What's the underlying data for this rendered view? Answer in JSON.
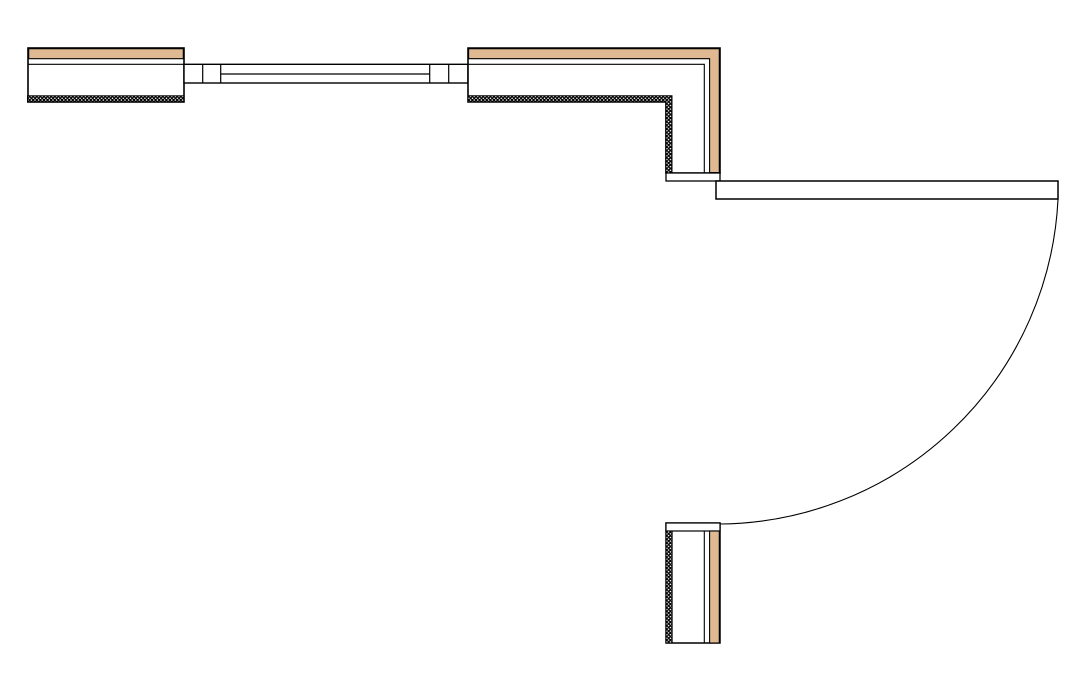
{
  "app": {
    "type": "cad-floor-plan-detail",
    "description": "Plan view of wall assembly with window, corner wall, and 90-degree open door with swing arc"
  },
  "canvas": {
    "width": 1088,
    "height": 681,
    "background": "#FFFFFF"
  },
  "colors": {
    "line": "#000000",
    "wood": "#DEB992",
    "white": "#FFFFFF",
    "stipple_bg": "#000000",
    "stipple_dot": "#FFFFFF"
  },
  "stipple": {
    "tile": 3.6,
    "dot_r": 0.75
  },
  "elements": [
    {
      "name": "left-wall-body",
      "type": "rect",
      "x": 28,
      "y": 48,
      "w": 156,
      "h": 54,
      "fill": "white",
      "sw": 1.6
    },
    {
      "name": "left-wall-finish-band",
      "type": "rect",
      "x": 28.7,
      "y": 48.7,
      "w": 154.6,
      "h": 10,
      "fill": "wood",
      "sw": 1.1
    },
    {
      "name": "left-wall-finish-line",
      "type": "line",
      "x1": 28,
      "y1": 64.3,
      "x2": 184,
      "y2": 64.3,
      "sw": 1.1
    },
    {
      "name": "left-wall-insulation-band",
      "type": "rect",
      "x": 27.5,
      "y": 95.8,
      "w": 156.5,
      "h": 6.2,
      "fill": "stipple",
      "sw": 1.0
    },
    {
      "name": "window-frame",
      "type": "rect",
      "x": 184,
      "y": 64.3,
      "w": 284,
      "h": 18.7,
      "fill": "white",
      "sw": 1.4
    },
    {
      "name": "window-jamb-line",
      "type": "line",
      "x1": 202.7,
      "y1": 64.3,
      "x2": 202.7,
      "y2": 83,
      "sw": 1.2
    },
    {
      "name": "window-jamb-line",
      "type": "line",
      "x1": 220.7,
      "y1": 64.3,
      "x2": 220.7,
      "y2": 83,
      "sw": 1.2
    },
    {
      "name": "window-jamb-line",
      "type": "line",
      "x1": 429.7,
      "y1": 64.3,
      "x2": 429.7,
      "y2": 83,
      "sw": 1.2
    },
    {
      "name": "window-jamb-line",
      "type": "line",
      "x1": 448.7,
      "y1": 64.3,
      "x2": 448.7,
      "y2": 83,
      "sw": 1.2
    },
    {
      "name": "window-glass-line",
      "type": "line",
      "x1": 220.7,
      "y1": 74,
      "x2": 429.7,
      "y2": 74,
      "sw": 1.2
    },
    {
      "name": "corner-wall-body",
      "type": "path",
      "d": "M468,48 H720 V173 H666 V102 H468 Z",
      "fill": "white",
      "sw": 1.6
    },
    {
      "name": "corner-wall-finish-band",
      "type": "path",
      "d": "M468.6,48.7 H719.3 V172.5 H709.6 V58.7 H468.6 Z",
      "fill": "wood",
      "sw": 1.1
    },
    {
      "name": "corner-wall-finish-line",
      "type": "path",
      "d": "M468,64.3 H704.3 V173",
      "fill": "none",
      "sw": 1.1
    },
    {
      "name": "corner-wall-insulation-band",
      "type": "path",
      "d": "M468,95.8 H672 V173 H665.8 V102 H468 Z",
      "fill": "stipple",
      "sw": 1.0
    },
    {
      "name": "door-head-jamb-cap",
      "type": "rect",
      "x": 666,
      "y": 173,
      "w": 54,
      "h": 8,
      "fill": "white",
      "sw": 1.3
    },
    {
      "name": "door-leaf",
      "type": "rect",
      "x": 716,
      "y": 181,
      "w": 342,
      "h": 18,
      "fill": "white",
      "sw": 1.5
    },
    {
      "name": "door-swing-arc",
      "type": "path",
      "d": "M1058,199.5 A341.5,341.5 0 0 1 719.5,524",
      "fill": "none",
      "sw": 1.1
    },
    {
      "name": "lower-wall-body",
      "type": "rect",
      "x": 666,
      "y": 523,
      "w": 54,
      "h": 120,
      "fill": "white",
      "sw": 1.5
    },
    {
      "name": "lower-wall-jamb-cap",
      "type": "rect",
      "x": 666,
      "y": 523,
      "w": 54,
      "h": 8,
      "fill": "white",
      "sw": 1.2
    },
    {
      "name": "lower-wall-insulation-band",
      "type": "rect",
      "x": 666,
      "y": 531,
      "w": 6.2,
      "h": 112,
      "fill": "stipple",
      "sw": 0.9
    },
    {
      "name": "lower-wall-finish-line",
      "type": "line",
      "x1": 704.3,
      "y1": 531,
      "x2": 704.3,
      "y2": 643,
      "sw": 1.1
    },
    {
      "name": "lower-wall-finish-band",
      "type": "rect",
      "x": 709.6,
      "y": 531,
      "w": 9.7,
      "h": 112,
      "fill": "wood",
      "sw": 1.1
    }
  ]
}
